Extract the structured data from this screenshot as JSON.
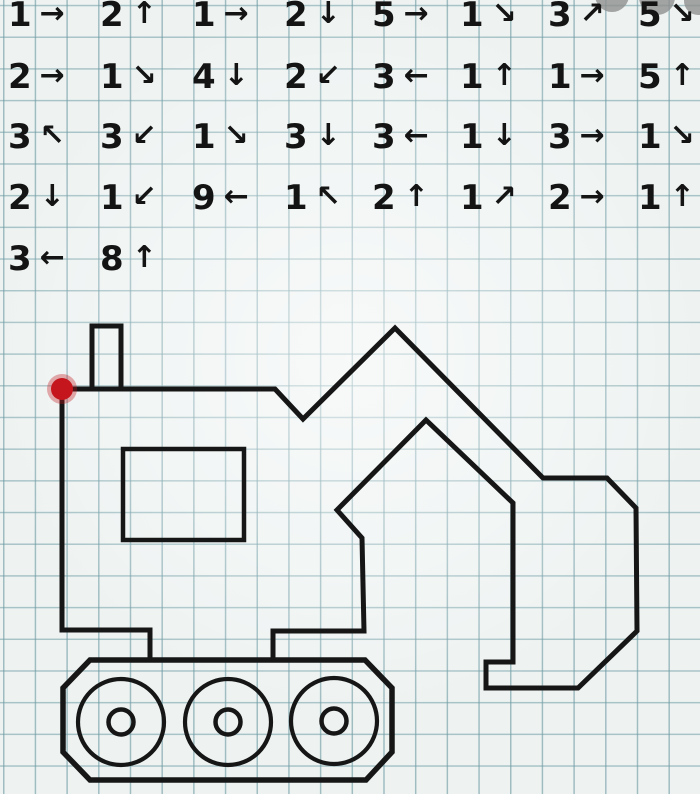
{
  "worksheet": {
    "kind": "graphical-dictation-grid-worksheet",
    "figure": "excavator"
  },
  "colors": {
    "paper": "#eef3f2",
    "grid_line": "#6e9ba3",
    "ink": "#161616",
    "start_dot": "#c4161c",
    "watermark_gray": "#8f8f8f"
  },
  "instructions": {
    "rows": [
      [
        {
          "count": "1",
          "arrow": "→",
          "dir": "right"
        },
        {
          "count": "2",
          "arrow": "↑",
          "dir": "up"
        },
        {
          "count": "1",
          "arrow": "→",
          "dir": "right"
        },
        {
          "count": "2",
          "arrow": "↓",
          "dir": "down"
        },
        {
          "count": "5",
          "arrow": "→",
          "dir": "right"
        },
        {
          "count": "1",
          "arrow": "↘",
          "dir": "down-right"
        },
        {
          "count": "3",
          "arrow": "↗",
          "dir": "up-right"
        },
        {
          "count": "5",
          "arrow": "↘",
          "dir": "down-right"
        }
      ],
      [
        {
          "count": "2",
          "arrow": "→",
          "dir": "right"
        },
        {
          "count": "1",
          "arrow": "↘",
          "dir": "down-right"
        },
        {
          "count": "4",
          "arrow": "↓",
          "dir": "down"
        },
        {
          "count": "2",
          "arrow": "↙",
          "dir": "down-left"
        },
        {
          "count": "3",
          "arrow": "←",
          "dir": "left"
        },
        {
          "count": "1",
          "arrow": "↑",
          "dir": "up"
        },
        {
          "count": "1",
          "arrow": "→",
          "dir": "right"
        },
        {
          "count": "5",
          "arrow": "↑",
          "dir": "up"
        }
      ],
      [
        {
          "count": "3",
          "arrow": "↖",
          "dir": "up-left"
        },
        {
          "count": "3",
          "arrow": "↙",
          "dir": "down-left"
        },
        {
          "count": "1",
          "arrow": "↘",
          "dir": "down-right"
        },
        {
          "count": "3",
          "arrow": "↓",
          "dir": "down"
        },
        {
          "count": "3",
          "arrow": "←",
          "dir": "left"
        },
        {
          "count": "1",
          "arrow": "↓",
          "dir": "down"
        },
        {
          "count": "3",
          "arrow": "→",
          "dir": "right"
        },
        {
          "count": "1",
          "arrow": "↘",
          "dir": "down-right"
        }
      ],
      [
        {
          "count": "2",
          "arrow": "↓",
          "dir": "down"
        },
        {
          "count": "1",
          "arrow": "↙",
          "dir": "down-left"
        },
        {
          "count": "9",
          "arrow": "←",
          "dir": "left"
        },
        {
          "count": "1",
          "arrow": "↖",
          "dir": "up-left"
        },
        {
          "count": "2",
          "arrow": "↑",
          "dir": "up"
        },
        {
          "count": "1",
          "arrow": "↗",
          "dir": "up-right"
        },
        {
          "count": "2",
          "arrow": "→",
          "dir": "right"
        },
        {
          "count": "1",
          "arrow": "↑",
          "dir": "up"
        }
      ],
      [
        {
          "count": "3",
          "arrow": "←",
          "dir": "left"
        },
        {
          "count": "8",
          "arrow": "↑",
          "dir": "up"
        }
      ]
    ]
  },
  "drawing": {
    "outline_points": "150,660 150,630 62,630 62,389 275,389 303,419 395,328 543,478 607,478 636,508 637,631 578,688 486,688 486,662 513,662 513,503 426,420 337,510 362,538 364,631 273,631 273,660",
    "exhaust_points": "92,389 92,326 121,326 121,389",
    "window_points": "123,449 244,449 244,540 123,540",
    "track_points": "90,660 365,660 392,688 392,752 366,780 90,780 63,752 63,688",
    "wheels": [
      {
        "cx": 121,
        "cy": 722
      },
      {
        "cx": 228,
        "cy": 722
      },
      {
        "cx": 334,
        "cy": 721
      }
    ],
    "wheel_outer_r": 43,
    "wheel_hub_r": 12.5,
    "start_dot": {
      "cx": 62,
      "cy": 389,
      "r": 11
    },
    "watermark_circles": [
      {
        "cx": 612,
        "cy": -5,
        "r": 17
      },
      {
        "cx": 657,
        "cy": -3,
        "r": 18
      },
      {
        "cx": 698,
        "cy": 1,
        "r": 14
      }
    ]
  }
}
